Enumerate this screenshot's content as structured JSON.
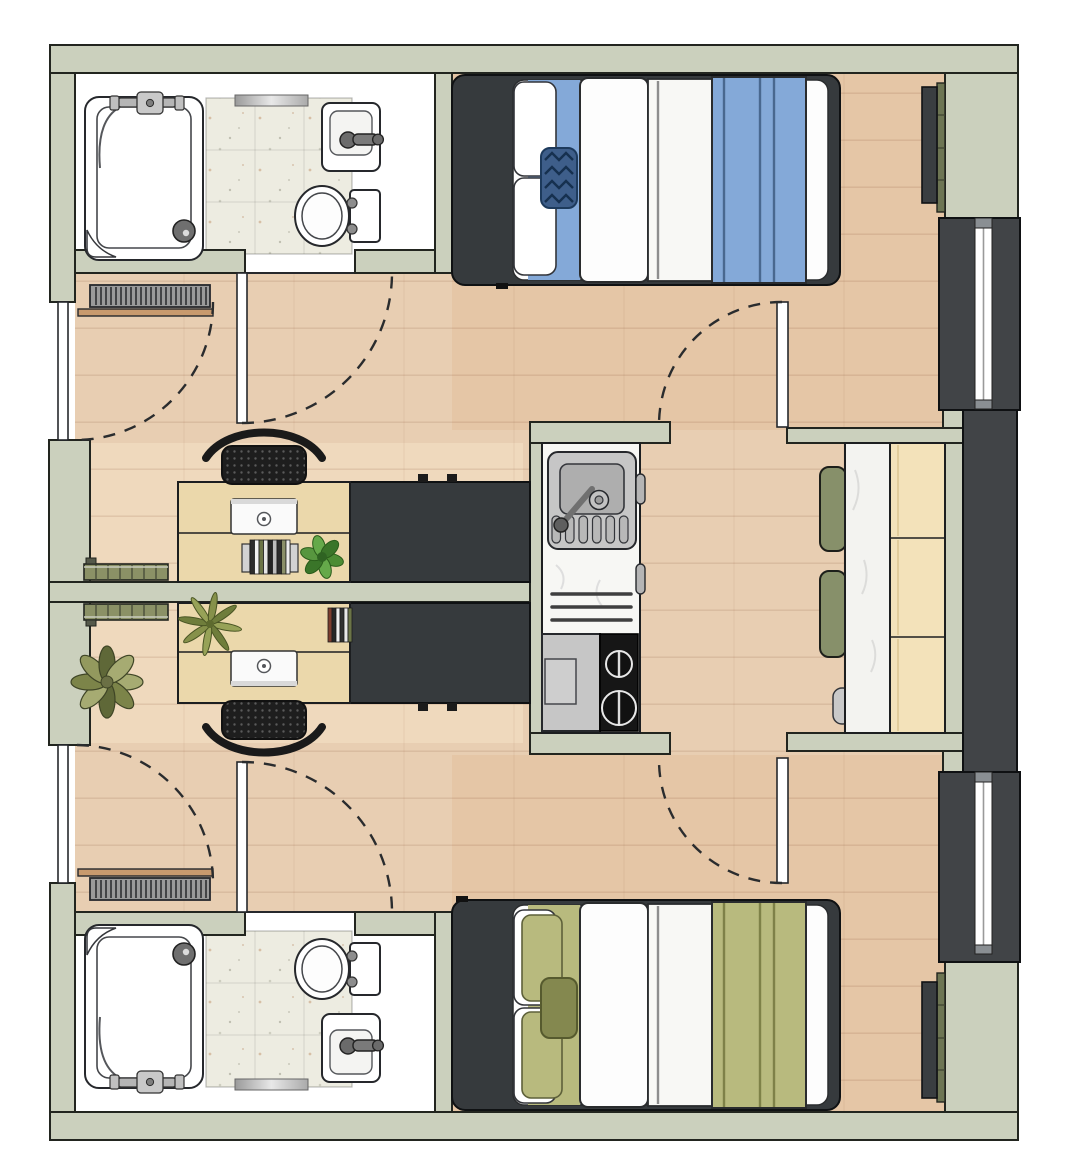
{
  "document": {
    "kind": "architectural floor plan drawing",
    "visible_text": "",
    "units_count": 2
  },
  "colors": {
    "page_bg": "#ffffff",
    "wall": "#cbd0bd",
    "wall_outline": "#22251f",
    "floor_wood": "#e8ceb2",
    "floor_tint_bedroom": "#dfb28c",
    "floor_tint_hall": "#f6e3c8",
    "tile": "#edece1",
    "dark_furniture": "#363a3d",
    "dark_panel": "#414447",
    "bed_blue": "#84a9d8",
    "bed_blue_dark": "#3e5e8a",
    "bed_blue_line": "#49688f",
    "bed_olive": "#b8ba7e",
    "bed_olive_dark": "#84884f",
    "bed_olive_line": "#7e8148",
    "duvet_white": "#fdfdfd",
    "desk_wood": "#ebd8ab",
    "cabinet_wood": "#f3e2ba",
    "marble": "#f3f3f0",
    "chair_olive": "#87906a",
    "chair_black": "#1e1e1e",
    "radiator_olive": "#8b9166",
    "tv_backing_olive": "#6d7553",
    "steel": "#c4c4c4",
    "steel_dark": "#aeaeae",
    "stove_black": "#161616",
    "plant_green": "#4c8c34",
    "plant_olive": "#97a257",
    "plant_sage": "#a6ab72",
    "shelf_wood": "#c89a6e",
    "glass_white": "#ffffff"
  },
  "floorplan": {
    "shared_spaces": [
      "kitchenette",
      "dining-nook",
      "central-corridor"
    ],
    "kitchenette_fixtures": [
      "stainless-sink",
      "faucet",
      "control-knob",
      "drain-grooves",
      "towel-rails",
      "mini-appliance",
      "two-burner-stove",
      "door-handles"
    ],
    "dining_fixtures": [
      "marble-table",
      "olive-chair",
      "olive-chair",
      "gray-stool",
      "wood-cabinet-3-sections"
    ],
    "units": [
      {
        "id": "unit-top",
        "bedding_color_name": "blue",
        "fixtures": [
          "entry-door",
          "door-swing-arc",
          "bathroom",
          "shower",
          "shower-drain",
          "shower-fixture",
          "toilet",
          "hand-sink",
          "tile-floor",
          "bathroom-door",
          "wall-radiator",
          "wood-shelf",
          "double-bed",
          "pillows",
          "zigzag-cushion",
          "white-duvet",
          "blue-duvet",
          "wardrobe",
          "desk",
          "laptop",
          "books",
          "desk-plant",
          "mesh-office-chair",
          "divider-radiator",
          "wall-tv",
          "window"
        ]
      },
      {
        "id": "unit-bottom",
        "bedding_color_name": "olive",
        "fixtures": [
          "entry-door",
          "door-swing-arc",
          "bathroom",
          "shower",
          "shower-drain",
          "shower-fixture",
          "toilet",
          "hand-sink",
          "tile-floor",
          "bathroom-door",
          "wall-radiator",
          "wood-shelf",
          "double-bed",
          "pillows",
          "olive-cushion",
          "white-duvet",
          "olive-duvet",
          "wardrobe",
          "desk",
          "laptop",
          "books",
          "desk-plant",
          "mesh-office-chair",
          "divider-radiator",
          "wall-tv",
          "window",
          "floor-plant"
        ]
      }
    ]
  }
}
